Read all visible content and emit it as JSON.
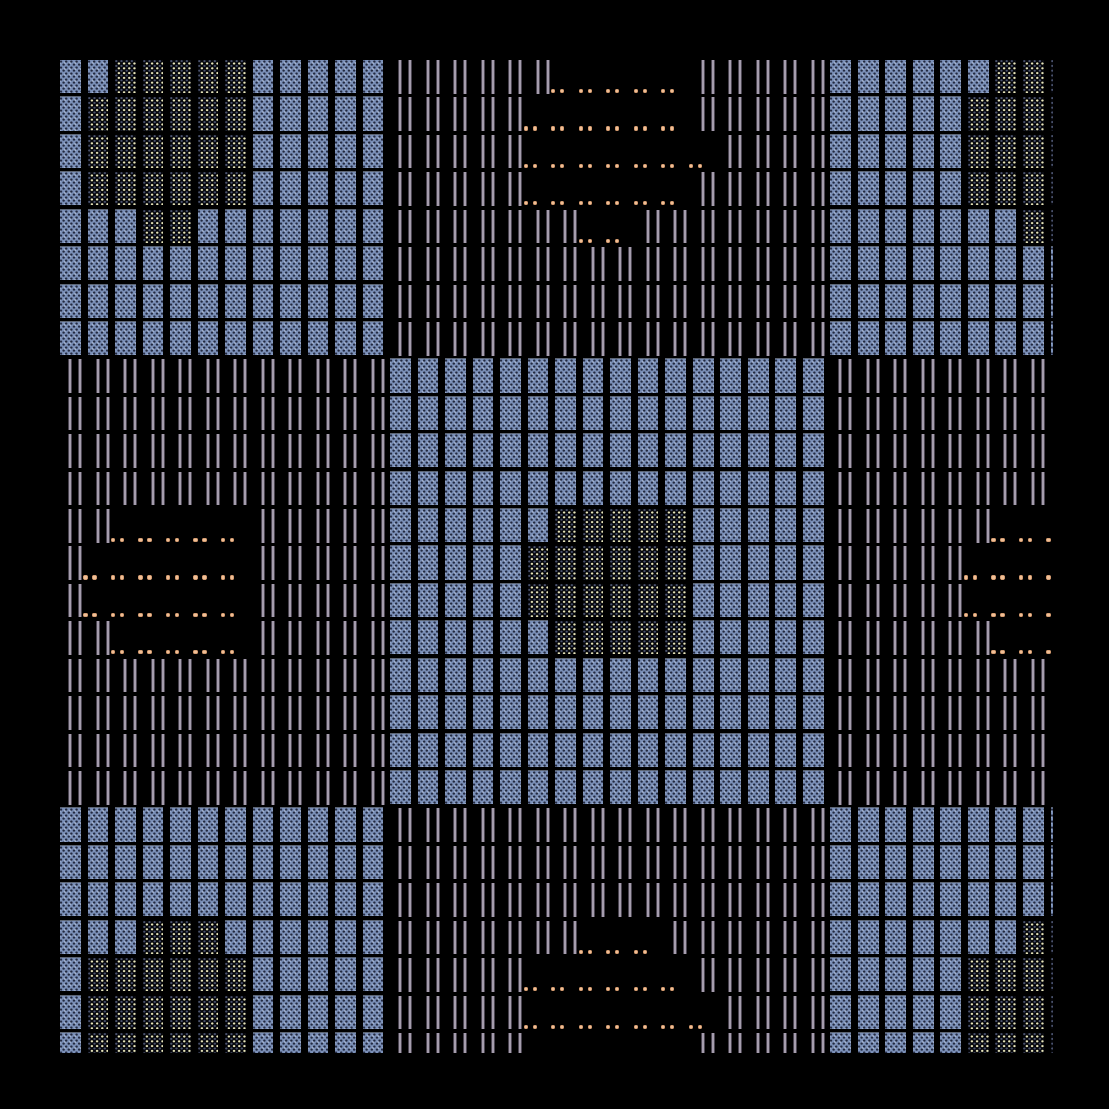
{
  "artwork": {
    "title": "generative-textile-tile-grid",
    "background_color": "#000000",
    "canvas": {
      "left": 60,
      "top": 60,
      "width": 993,
      "height": 993
    },
    "grid": {
      "columns": 37,
      "rows": 27,
      "col_pitch": 27.514,
      "row_pitch": 37.42,
      "tile_width": 20.7,
      "tile_height": 33.2
    },
    "palette": {
      "blue_base": "#7c91b9",
      "blue_texture_dark": "#222940",
      "blue_texture_light": "#a9b9d6",
      "yellow_dot_bright": "#e9e6ba",
      "yellow_dot_dim": "#4a526d",
      "line_core": "#a59dad",
      "line_edge": "#4a4450",
      "orange_dot": "#efc098",
      "orange_dot_edge": "#cf9468"
    },
    "tile_types": {
      "B": "woven-blue-block",
      "Y": "dotted-cream-block",
      "L": "double-vertical-lines",
      "O": "orange-dot-pair"
    },
    "orange_dot_geometry": {
      "dot1_offset_x": -4.1,
      "dot2_offset_x": 4.9,
      "offset_y": 29.0,
      "diameter": 4.2
    },
    "map": [
      "BBYYYYYBBBBBLLLLLLOOOOOLLLLLBBBBBBYYY",
      "BYYYYYYBBBBBLLLLLOOOOOOLLLLLBBBBBYYYY",
      "BYYYYYYBBBBBLLLLLOOOOOOOLLLLBBBBBYYYY",
      "BYYYYYYBBBBBLLLLLOOOOOOLLLLLBBBBBYYYY",
      "BBBYYBBBBBBBLLLLLLLOOLLLLLLLBBBBBBBYY",
      "BBBBBBBBBBBBLLLLLLLLLLLLLLLLBBBBBBBBB",
      "BBBBBBBBBBBBLLLLLLLLLLLLLLLLBBBBBBBBB",
      "BBBBBBBBBBBBLLLLLLLLLLLLLLLLBBBBBBBBB",
      "LLLLLLLLLLLLBBBBBBBBBBBBBBBBLLLLLLLLL",
      "LLLLLLLLLLLLBBBBBBBBBBBBBBBBLLLLLLLLL",
      "LLLLLLLLLLLLBBBBBBBBBBBBBBBBLLLLLLLLL",
      "LLLLLLLLLLLLBBBBBBBBBBBBBBBBLLLLLLLLL",
      "LLOOOOOLLLLLBBBBBBYYYYYBBBBBLLLLLLOOO",
      "LOOOOOOLLLLLBBBBBYYYYYYBBBBBLLLLLOOOO",
      "LOOOOOOLLLLLBBBBBYYYYYYBBBBBLLLLLOOOO",
      "LLOOOOOLLLLLBBBBBBYYYYYBBBBBLLLLLLOOO",
      "LLLLLLLLLLLLBBBBBBBBBBBBBBBBLLLLLLLLL",
      "LLLLLLLLLLLLBBBBBBBBBBBBBBBBLLLLLLLLL",
      "LLLLLLLLLLLLBBBBBBBBBBBBBBBBLLLLLLLLL",
      "LLLLLLLLLLLLBBBBBBBBBBBBBBBBLLLLLLLLL",
      "BBBBBBBBBBBBLLLLLLLLLLLLLLLLBBBBBBBBB",
      "BBBBBBBBBBBBLLLLLLLLLLLLLLLLBBBBBBBBB",
      "BBBBBBBBBBBBLLLLLLLLLLLLLLLLBBBBBBBBB",
      "BBBYYYBBBBBBLLLLLLLOOOLLLLLLBBBBBBBYY",
      "BYYYYYYBBBBBLLLLLOOOOOOLLLLLBBBBBYYYY",
      "BYYYYYYBBBBBLLLLLOOOOOOOLLLLBBBBBYYYY",
      "BYYYYYYBBBBBLLLLLOOOOOOLLLLLBBBBBYYYY"
    ]
  }
}
